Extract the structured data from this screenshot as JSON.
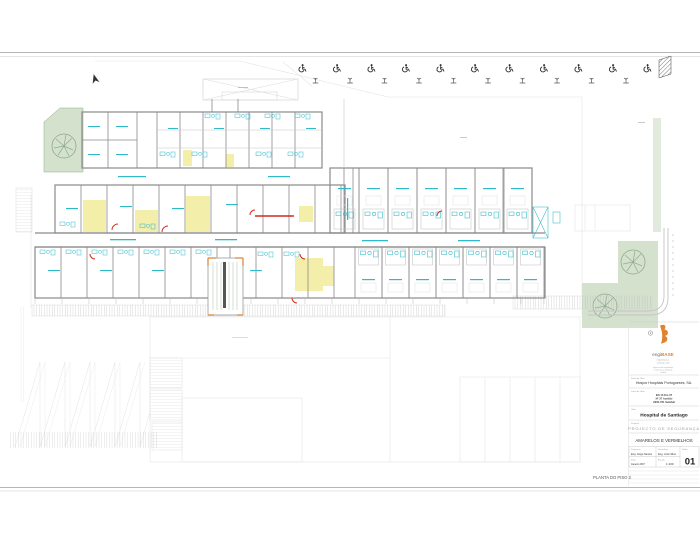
{
  "palette": {
    "line_dark": "#8a8a8a",
    "line_light": "#c6c6c6",
    "line_faint": "#e4e4e4",
    "cyan": "#2fb9c9",
    "yellow": "#f2eda0",
    "green_fill": "#d4e1cd",
    "green_line": "#8fac8c",
    "orange": "#e0832f",
    "red": "#d42a1e",
    "text_dark": "#333333",
    "text_gray": "#9a9a9a"
  },
  "sheet": {
    "plan_label": "PLANTA DO PISO 2"
  },
  "site": {
    "accessible_parking_count": 11
  },
  "title_block": {
    "brand": {
      "prefix": "engi",
      "suffix": "BASE",
      "tagline1": "engenharia e",
      "tagline2": "sistemas, lda",
      "reg1": "projectos de engenharia",
      "reg2": "e seguranca integrada",
      "reg3": "setubal"
    },
    "fields": {
      "client_label": "Dono da Obra",
      "client": "Hospor Hospitais Portugueses, SA.",
      "location_label": "Local da Obra",
      "address1": "EN 10 Km 37",
      "address2": "Nº 37 Azeitão",
      "address3": "2900-761 Setúbal",
      "work_label": "Obra",
      "work": "Hospital de Santiago",
      "project_label": "Projecto",
      "project": "PROJECTO  DE  SEGURANÇA",
      "drawing": "AMARELOS E VERMELHOS",
      "designed_label": "Projectou",
      "designed": "Eng. Hugo Santos",
      "drawn_label": "Desenhou",
      "drawn": "Eng. José Silva",
      "sheet_label": "Folha",
      "sheet_number": "01",
      "date_label": "Data",
      "date": "Janeiro 2007",
      "scale_label": "Escala",
      "scale": "1:100"
    }
  }
}
